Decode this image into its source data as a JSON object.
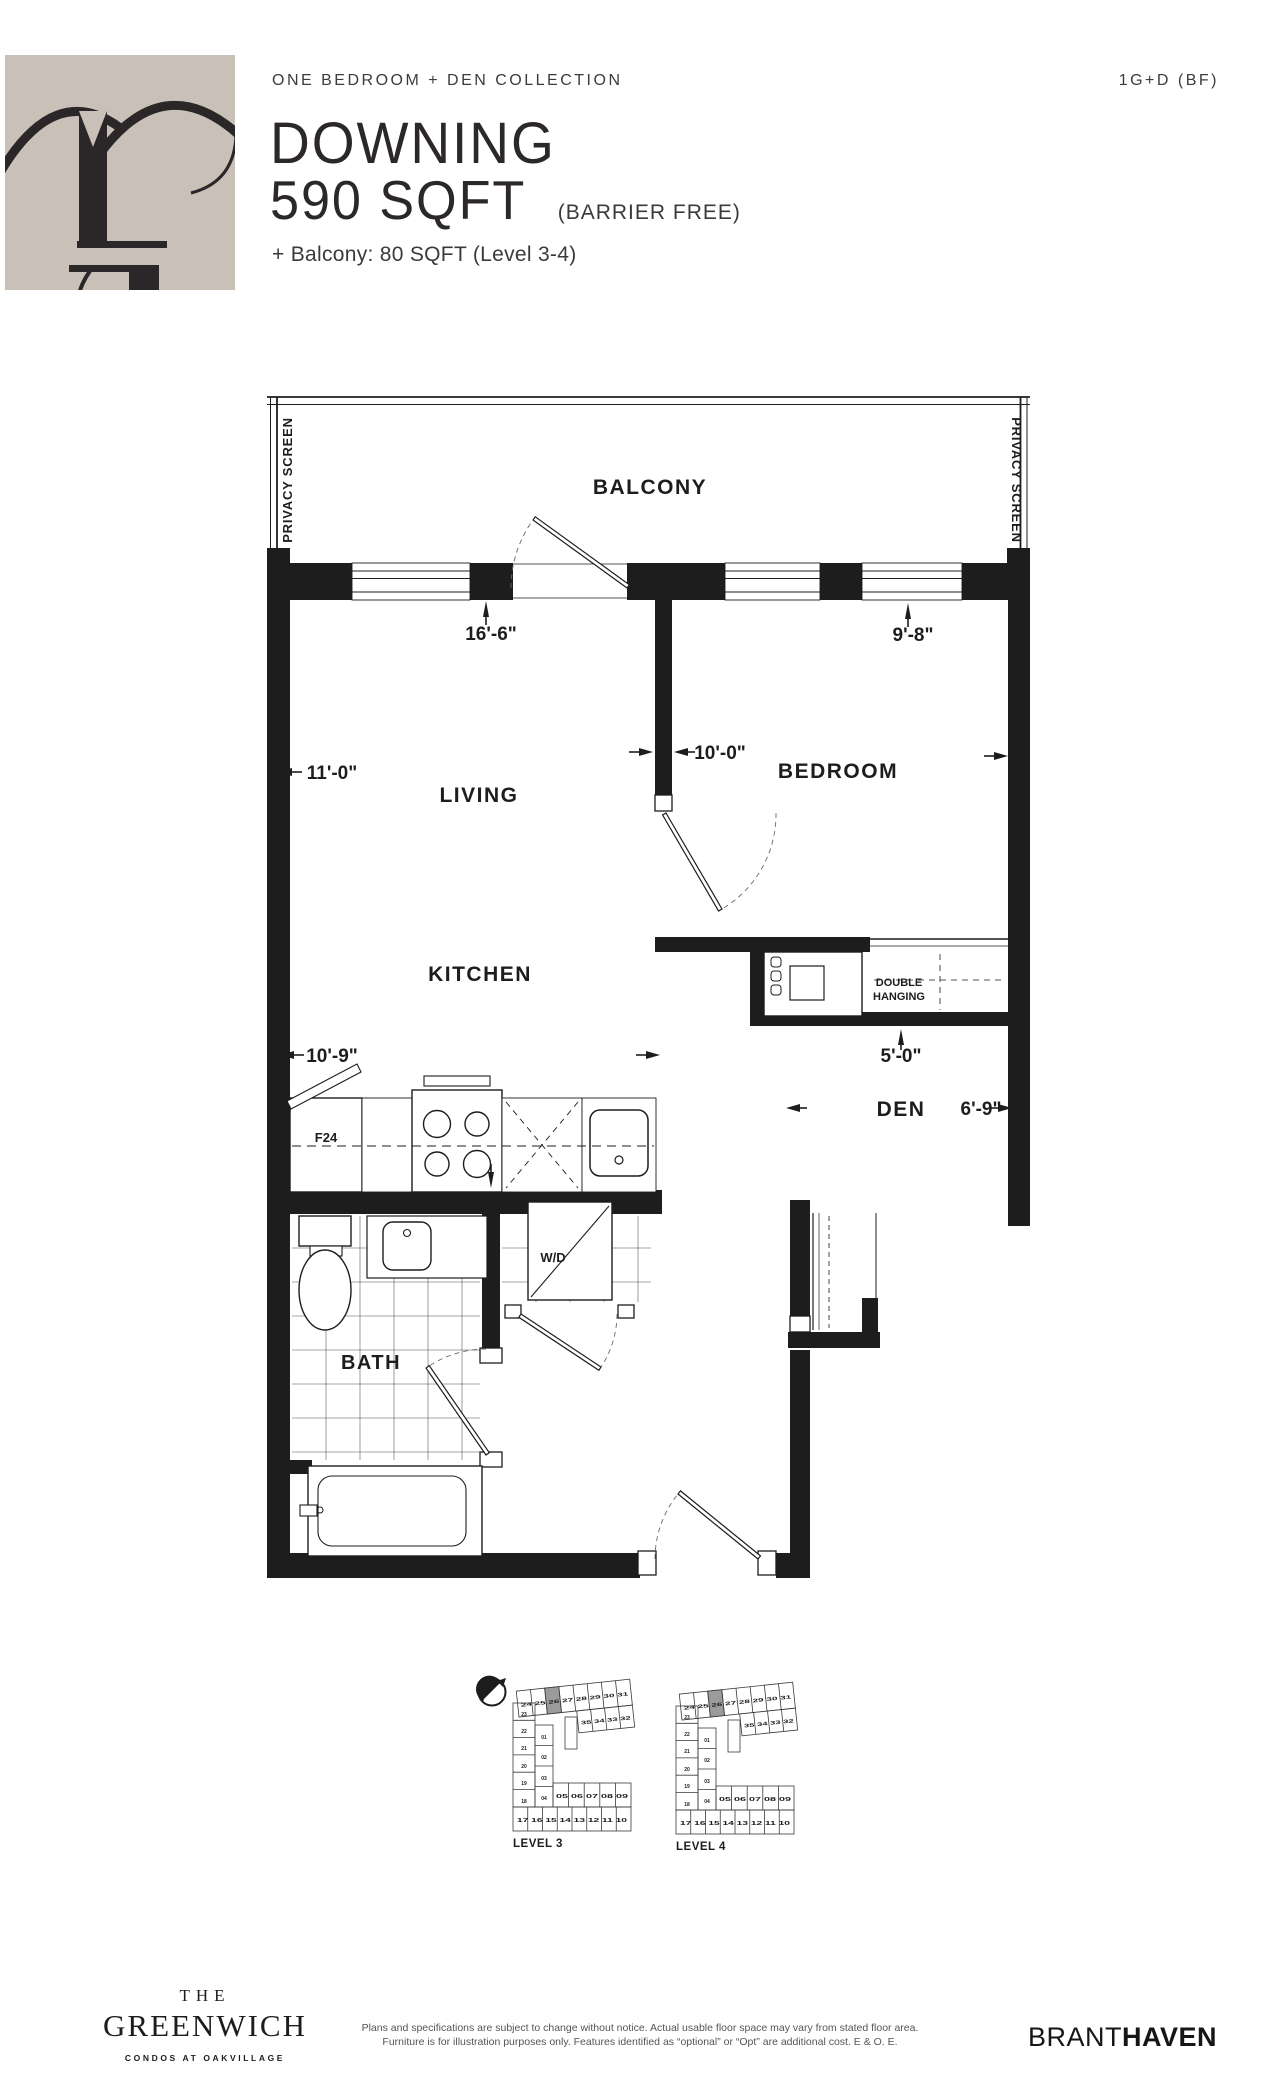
{
  "page": {
    "background": "#ffffff",
    "ink": "#1d1d1d",
    "logo_beige": "#c9c0b8",
    "keyplan_highlight": "#9b9b9b"
  },
  "header": {
    "collection": "ONE BEDROOM + DEN COLLECTION",
    "unit_code": "1G+D (BF)",
    "plan_name": "DOWNING",
    "area": "590 SQFT",
    "barrier_free_note": "(BARRIER FREE)",
    "balcony_note": "+ Balcony: 80 SQFT (Level 3-4)"
  },
  "floor_plan": {
    "balcony_label": "BALCONY",
    "privacy_screen_left": "PRIVACY SCREEN",
    "privacy_screen_right": "PRIVACY SCREEN",
    "rooms": {
      "living": "LIVING",
      "kitchen": "KITCHEN",
      "bedroom": "BEDROOM",
      "den": "DEN",
      "bath": "BATH"
    },
    "fixtures": {
      "fridge": "F24",
      "washer_dryer": "W/D",
      "closet_line1": "DOUBLE",
      "closet_line2": "HANGING"
    },
    "dimensions": {
      "living_width": "11'-0\"",
      "living_kitchen_depth": "16'-6\"",
      "kitchen_width": "10'-9\"",
      "bedroom_width": "9'-8\"",
      "living_bedroom_wall": "10'-0\"",
      "den_depth": "5'-0\"",
      "den_width": "6'-9\""
    }
  },
  "key_plans": {
    "levels": [
      {
        "label": "LEVEL 3",
        "top_row": "24 25 26 27 28 29 30 31",
        "wing_row": "35 34 33 32",
        "left_col": [
          "23",
          "22",
          "21",
          "20",
          "19",
          "18"
        ],
        "inner_col": [
          "01",
          "02",
          "03",
          "04"
        ],
        "inner_row": "05 06 07 08 09",
        "bottom_row": "17 16 15 14 13 12 11 10"
      },
      {
        "label": "LEVEL 4",
        "top_row": "24 25 26 27 28 29 30 31",
        "wing_row": "35 34 33 32",
        "left_col": [
          "23",
          "22",
          "21",
          "20",
          "19",
          "18"
        ],
        "inner_col": [
          "01",
          "02",
          "03",
          "04"
        ],
        "inner_row": "05 06 07 08 09",
        "bottom_row": "17 16 15 14 13 12 11 10"
      }
    ]
  },
  "footer": {
    "brand": {
      "the": "THE",
      "name": "GREENWICH",
      "tagline": "CONDOS AT OAKVILLAGE"
    },
    "disclaimer_line1": "Plans and specifications are subject to change without notice. Actual usable floor space may vary from stated floor area.",
    "disclaimer_line2": "Furniture is for illustration purposes only. Features identified as “optional” or “Opt” are additional cost. E & O. E.",
    "developer": {
      "brant": "BRANT",
      "haven": "HAVEN"
    }
  }
}
